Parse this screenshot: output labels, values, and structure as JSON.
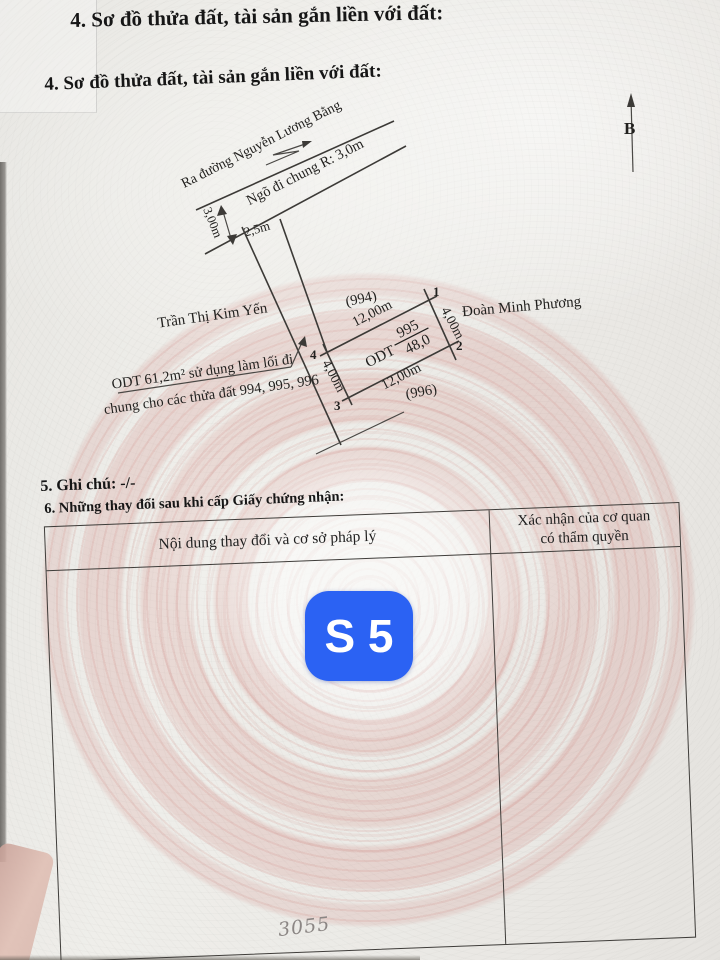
{
  "page": {
    "section4_title_top": "4. Sơ đồ thửa đất, tài sản gắn liền với đất:",
    "section4_title": "4. Sơ đồ thửa đất, tài sản gắn liền với đất:",
    "section5_title": "5. Ghi chú: -/-",
    "section6_title": "6. Những thay đổi sau khi cấp Giấy chứng nhận:"
  },
  "diagram": {
    "road_label": "Ra đường Nguyễn Lương Bằng",
    "alley_label": "Ngõ đi chung R: 3,0m",
    "road_width": "3,00m",
    "alley_width": "2,5m",
    "north_label": "B",
    "neighbor_left": "Trần Thị Kim Yến",
    "neighbor_right": "Đoàn Minh Phương",
    "parcel_above": "(994)",
    "parcel_below": "(996)",
    "edge_top_length": "12,00m",
    "edge_bottom_length": "12,00m",
    "edge_left_length": "4,00m",
    "edge_right_length": "4,00m",
    "corner_1": "1",
    "corner_2": "2",
    "corner_3": "3",
    "corner_4": "4",
    "parcel_use": "ODT",
    "parcel_number": "995",
    "parcel_area": "48,0",
    "note_line1": "ODT 61,2m² sử dụng làm lối đi",
    "note_line2": "chung cho các thửa đất 994, 995, 996"
  },
  "table": {
    "col1_header": "Nội dung thay đổi và cơ sở pháp lý",
    "col2_header_line1": "Xác nhận của cơ quan",
    "col2_header_line2": "có thẩm quyền"
  },
  "overlay": {
    "badge_label": "S 5"
  },
  "annotations": {
    "handwritten_number": "3055"
  },
  "colors": {
    "badge_blue": "#2b62f3",
    "pattern_pink": "#d4887f",
    "paper": "#eceae6",
    "ink": "#1f1f1f"
  }
}
